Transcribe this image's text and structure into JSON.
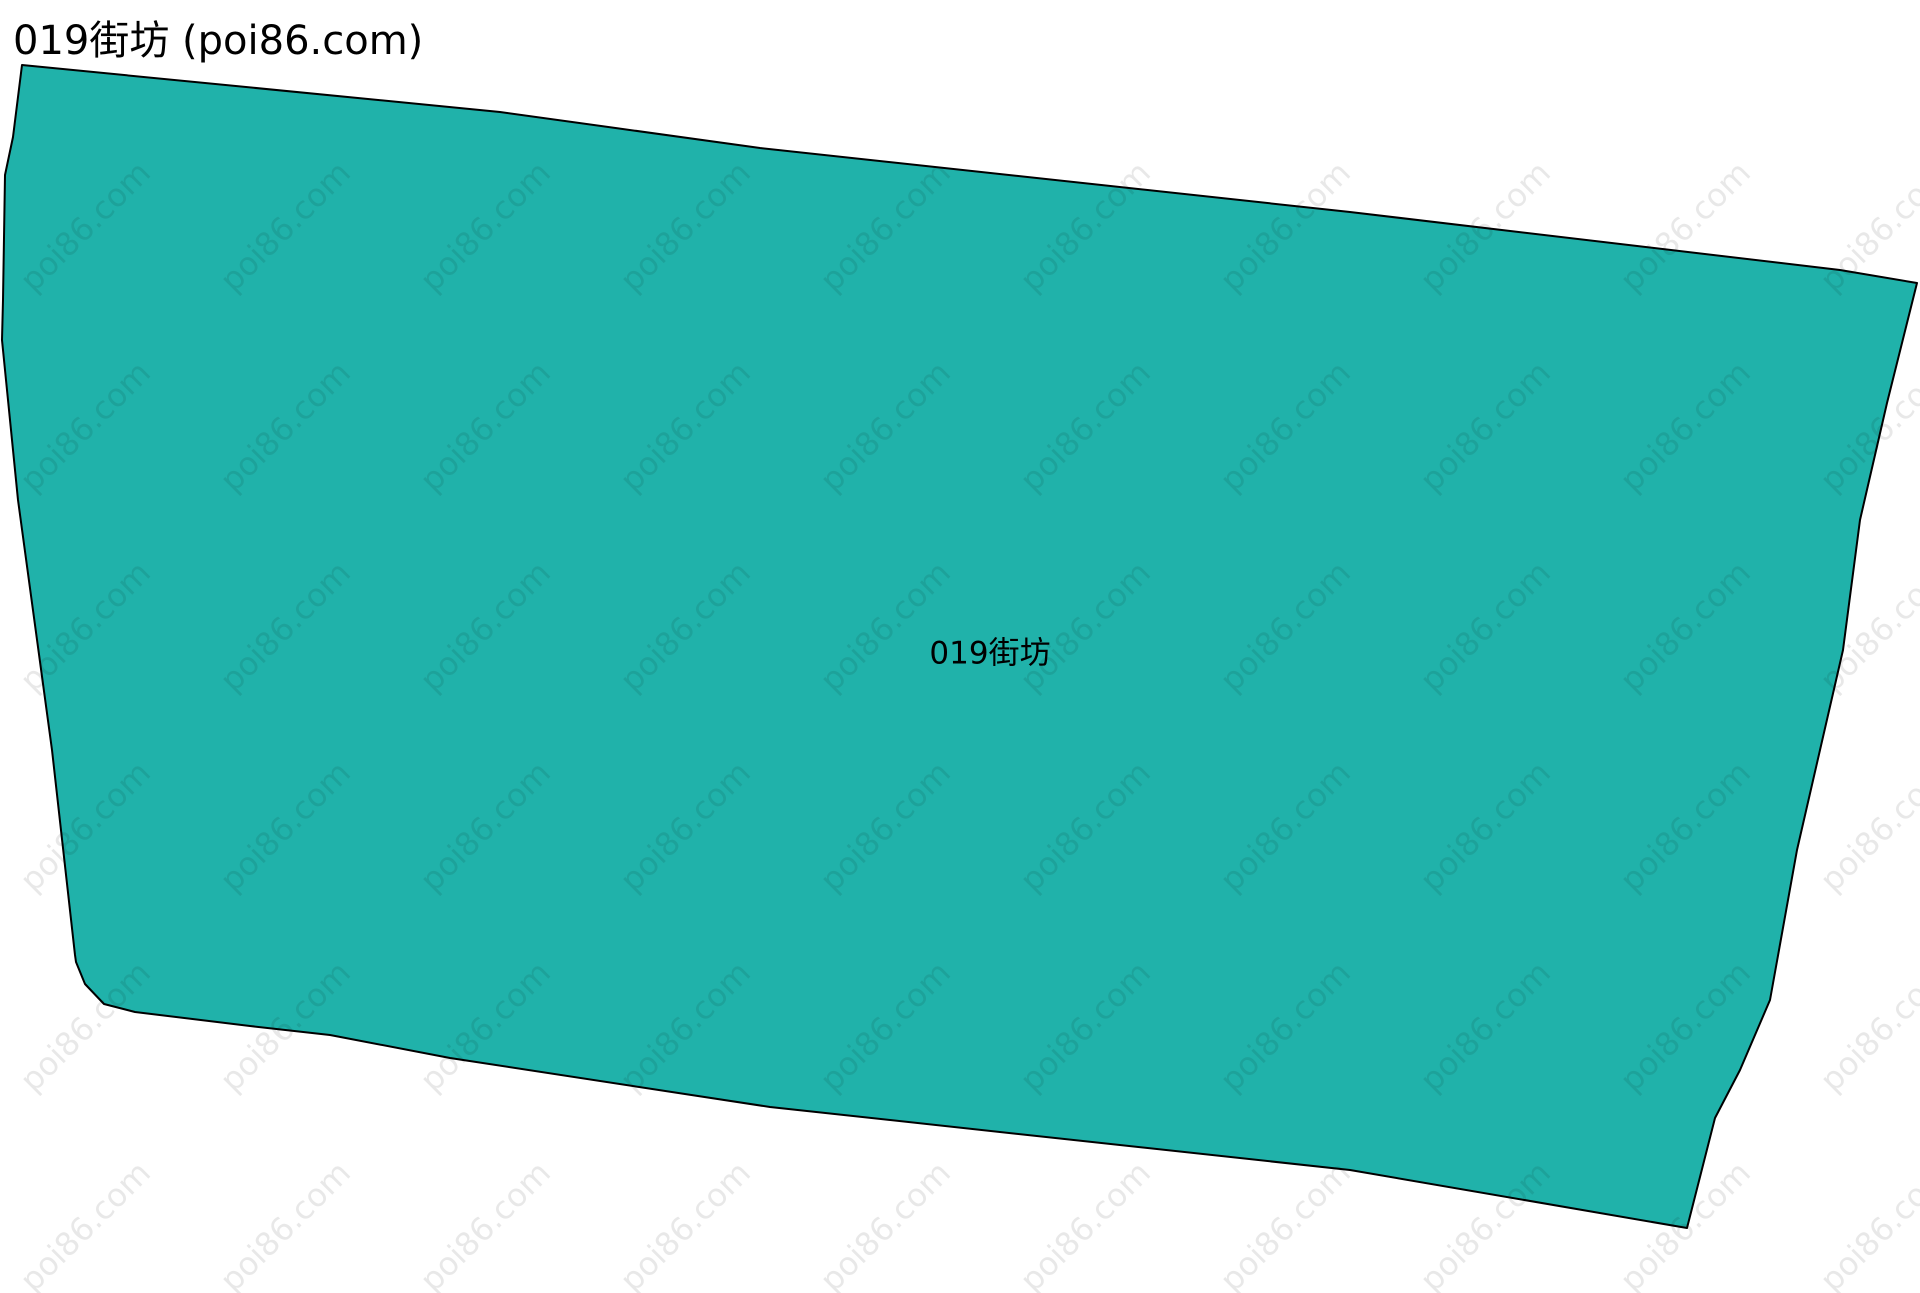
{
  "page": {
    "title": "019街坊 (poi86.com)",
    "width": 1920,
    "height": 1293,
    "background": "#ffffff"
  },
  "map": {
    "region_label": "019街坊",
    "label_x": 990,
    "label_y": 650,
    "fill_color": "#20b2aa",
    "outline_color": "#000000",
    "outline_width": 2,
    "polygon_points": "22,65 500,112 760,148 1350,212 1840,270 1917,283 1887,403 1860,520 1843,650 1797,850 1770,1000 1740,1070 1715,1118 1687,1228 1350,1170 770,1107 450,1058 330,1035 250,1026 135,1012 104,1004 85,984 76,962 75,955 52,750 18,500 2,340 3,300 5,175 13,137"
  },
  "watermark": {
    "text": "poi86.com",
    "color": "rgba(0, 0, 0, 0.09)",
    "font_size": 32,
    "rotation_deg": -45,
    "grid_start_x": 37,
    "grid_start_y": 297,
    "spacing_x": 200,
    "spacing_y": 200,
    "columns": 10,
    "rows": 6
  }
}
